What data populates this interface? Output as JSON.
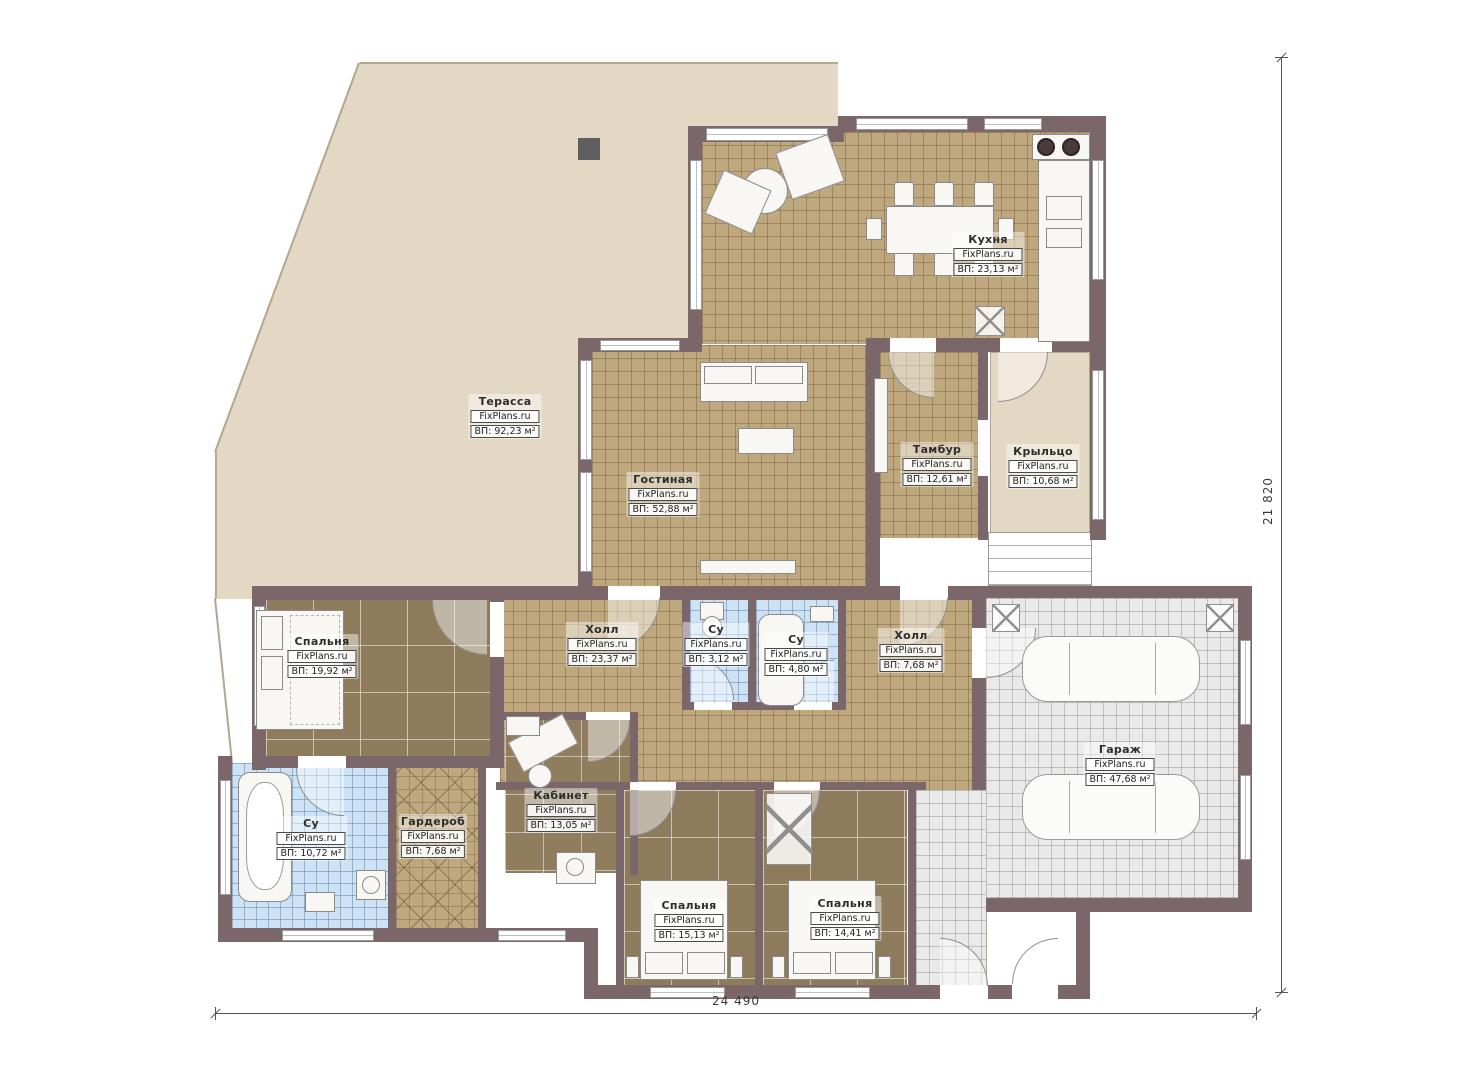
{
  "plan": {
    "rooms": [
      {
        "name": "Терасса",
        "site": "FixPlans.ru",
        "area": "ВП: 92,23 м²"
      },
      {
        "name": "Кухня",
        "site": "FixPlans.ru",
        "area": "ВП: 23,13 м²"
      },
      {
        "name": "Гостиная",
        "site": "FixPlans.ru",
        "area": "ВП: 52,88 м²"
      },
      {
        "name": "Тамбур",
        "site": "FixPlans.ru",
        "area": "ВП: 12,61 м²"
      },
      {
        "name": "Крыльцо",
        "site": "FixPlans.ru",
        "area": "ВП: 10,68 м²"
      },
      {
        "name": "Спальня",
        "site": "FixPlans.ru",
        "area": "ВП: 19,92 м²"
      },
      {
        "name": "Холл",
        "site": "FixPlans.ru",
        "area": "ВП: 23,37 м²"
      },
      {
        "name": "Су",
        "site": "FixPlans.ru",
        "area": "ВП: 3,12 м²"
      },
      {
        "name": "Су",
        "site": "FixPlans.ru",
        "area": "ВП: 4,80 м²"
      },
      {
        "name": "Холл",
        "site": "FixPlans.ru",
        "area": "ВП: 7,68 м²"
      },
      {
        "name": "Гараж",
        "site": "FixPlans.ru",
        "area": "ВП: 47,68 м²"
      },
      {
        "name": "Су",
        "site": "FixPlans.ru",
        "area": "ВП: 10,72 м²"
      },
      {
        "name": "Гардероб",
        "site": "FixPlans.ru",
        "area": "ВП: 7,68 м²"
      },
      {
        "name": "Кабинет",
        "site": "FixPlans.ru",
        "area": "ВП: 13,05 м²"
      },
      {
        "name": "Спальня",
        "site": "FixPlans.ru",
        "area": "ВП: 15,13 м²"
      },
      {
        "name": "Спальня",
        "site": "FixPlans.ru",
        "area": "ВП: 14,41 м²"
      }
    ],
    "dimensions": {
      "bottom": "24 490",
      "right": "21 820"
    },
    "colors": {
      "wall": "#7b6769",
      "terrace": "#e3d8c4",
      "tile_floor": "#bfa87e",
      "wood_floor": "#8d7b5c",
      "bath_floor": "#cde2f4",
      "garage_floor": "#e9e9e9"
    }
  }
}
